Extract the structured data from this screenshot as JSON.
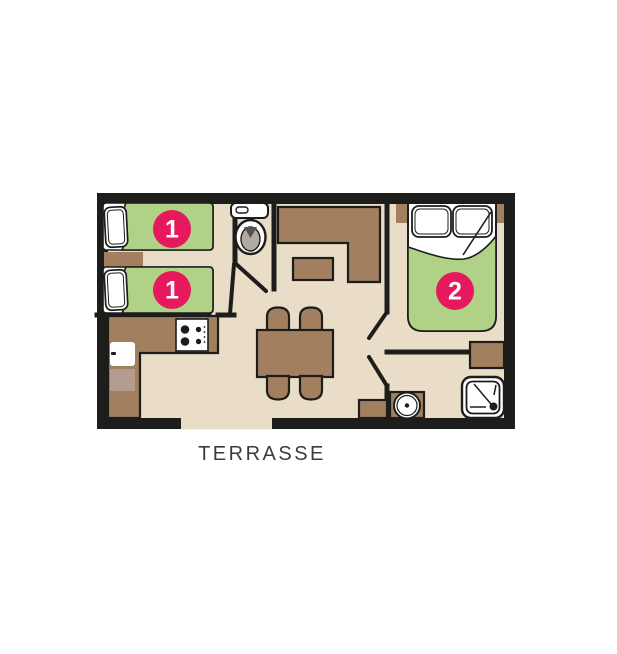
{
  "colors": {
    "white": "#ffffff",
    "floor": "#eaddc7",
    "wall": "#1d1d1b",
    "furniture": "#a17f5f",
    "furniture_light": "#b49d90",
    "bed_green": "#afd287",
    "badge": "#e5195c",
    "badge_text": "#ffffff",
    "toilet_inner": "#b3a9a3",
    "toilet_dark": "#57524d",
    "label": "#3c3c3b"
  },
  "labels": {
    "terrace": "TERRASSE"
  },
  "badges": {
    "bed1": "1",
    "bed2": "1",
    "double_bed": "2"
  }
}
